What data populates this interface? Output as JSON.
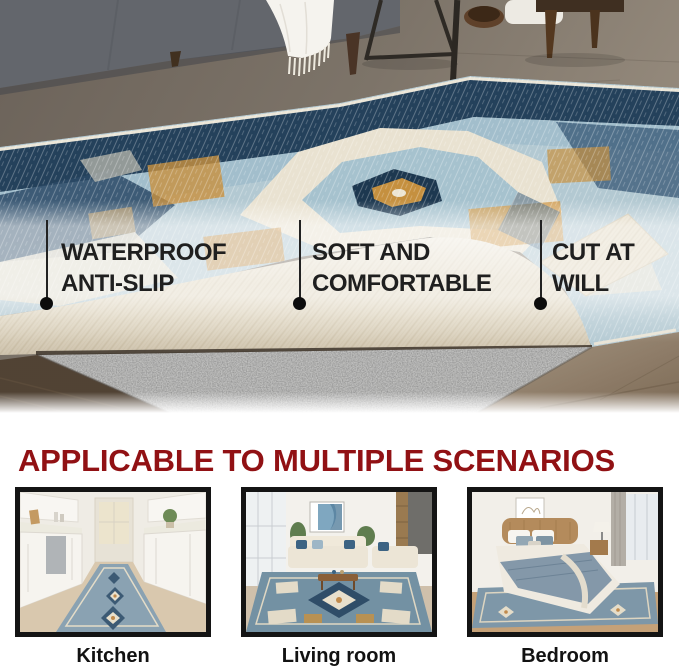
{
  "hero": {
    "description": "distressed blue oriental rug folded at one corner showing felt anti-slip pad, living room scene",
    "callouts": [
      {
        "line1": "WATERPROOF",
        "line2": "ANTI-SLIP"
      },
      {
        "line1": "SOFT AND",
        "line2": "COMFORTABLE"
      },
      {
        "line1": "CUT AT",
        "line2": "WILL"
      }
    ]
  },
  "scenarios": {
    "heading": "APPLICABLE TO MULTIPLE SCENARIOS",
    "cards": [
      {
        "label": "Kitchen"
      },
      {
        "label": "Living room"
      },
      {
        "label": "Bedroom"
      }
    ]
  },
  "colors": {
    "heading_red": "#911114",
    "callout_text": "#1f1f1f",
    "frame_black": "#141414",
    "rug_navy": "#24415b",
    "rug_light_blue": "#b3c9d2",
    "rug_cream": "#e9e2d1",
    "rug_tan": "#c9913f",
    "pad_gray": "#7d7d7d",
    "underside_cream": "#e3dac5"
  }
}
